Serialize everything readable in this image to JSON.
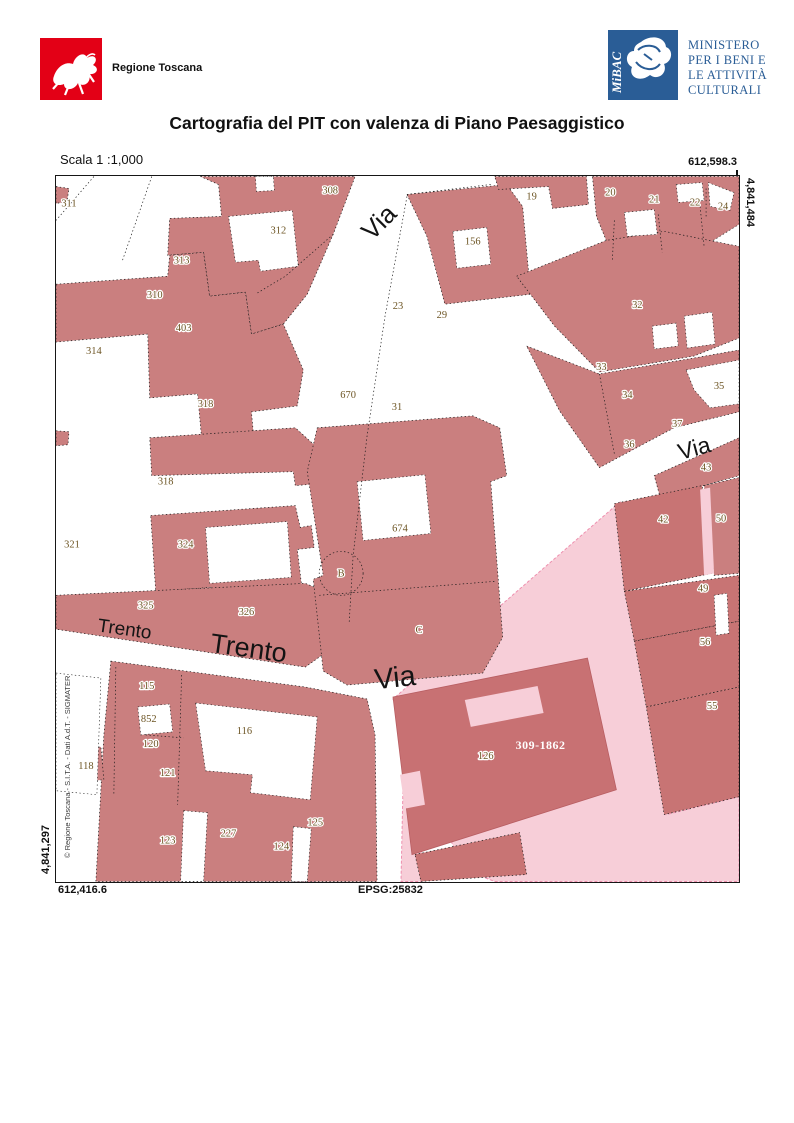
{
  "header": {
    "regione_label": "Regione Toscana",
    "mibac_logo_text": "MiBAC",
    "mibac_lines": [
      "MINISTERO",
      "PER I BENI E",
      "LE ATTIVITÀ",
      "CULTURALI"
    ]
  },
  "title": "Cartografia del PIT con valenza di Piano Paesaggistico",
  "scale_label": "Scala 1 :1,000",
  "coordinates": {
    "top_right": "612,598.3",
    "right_vertical": "4,841,484",
    "left_vertical": "4,841,297",
    "bottom_left": "612,416.6",
    "epsg": "EPSG:25832"
  },
  "attribution": "© Regione Toscana - S.I.T.A. - Dati A.d.T. - SIGMATER",
  "colors": {
    "building_rose": "#ca7f7f",
    "building_dark_rose": "#c87474",
    "zone_light_pink": "#f7ced8",
    "zone_border_pink": "#ee8fae",
    "parcel_text": "#6d5524",
    "regione_red": "#e30016",
    "mibac_blue": "#2a5d96"
  },
  "map": {
    "parcel_labels": [
      {
        "t": "311",
        "x": 13,
        "y": 30
      },
      {
        "t": "308",
        "x": 275,
        "y": 17
      },
      {
        "t": "312",
        "x": 223,
        "y": 57
      },
      {
        "t": "313",
        "x": 126,
        "y": 87
      },
      {
        "t": "310",
        "x": 99,
        "y": 122
      },
      {
        "t": "403",
        "x": 128,
        "y": 155
      },
      {
        "t": "314",
        "x": 38,
        "y": 178
      },
      {
        "t": "318",
        "x": 150,
        "y": 231
      },
      {
        "t": "318",
        "x": 110,
        "y": 309
      },
      {
        "t": "321",
        "x": 16,
        "y": 372
      },
      {
        "t": "324",
        "x": 130,
        "y": 372
      },
      {
        "t": "325",
        "x": 90,
        "y": 433
      },
      {
        "t": "326",
        "x": 191,
        "y": 440
      },
      {
        "t": "674",
        "x": 345,
        "y": 356
      },
      {
        "t": "670",
        "x": 293,
        "y": 222
      },
      {
        "t": "31",
        "x": 342,
        "y": 234
      },
      {
        "t": "23",
        "x": 343,
        "y": 133
      },
      {
        "t": "29",
        "x": 387,
        "y": 142
      },
      {
        "t": "156",
        "x": 418,
        "y": 68
      },
      {
        "t": "19",
        "x": 477,
        "y": 23
      },
      {
        "t": "20",
        "x": 556,
        "y": 19
      },
      {
        "t": "21",
        "x": 600,
        "y": 26
      },
      {
        "t": "22",
        "x": 641,
        "y": 29
      },
      {
        "t": "24",
        "x": 669,
        "y": 33
      },
      {
        "t": "32",
        "x": 583,
        "y": 132
      },
      {
        "t": "33",
        "x": 547,
        "y": 194
      },
      {
        "t": "34",
        "x": 573,
        "y": 222
      },
      {
        "t": "35",
        "x": 665,
        "y": 213
      },
      {
        "t": "37",
        "x": 623,
        "y": 251
      },
      {
        "t": "36",
        "x": 575,
        "y": 272
      },
      {
        "t": "43",
        "x": 652,
        "y": 295
      },
      {
        "t": "42",
        "x": 609,
        "y": 347
      },
      {
        "t": "50",
        "x": 667,
        "y": 346
      },
      {
        "t": "49",
        "x": 649,
        "y": 416
      },
      {
        "t": "56",
        "x": 651,
        "y": 470
      },
      {
        "t": "55",
        "x": 658,
        "y": 534
      },
      {
        "t": "115",
        "x": 91,
        "y": 514
      },
      {
        "t": "852",
        "x": 93,
        "y": 547
      },
      {
        "t": "120",
        "x": 95,
        "y": 572
      },
      {
        "t": "118",
        "x": 30,
        "y": 594
      },
      {
        "t": "121",
        "x": 112,
        "y": 601
      },
      {
        "t": "116",
        "x": 189,
        "y": 559
      },
      {
        "t": "123",
        "x": 112,
        "y": 669
      },
      {
        "t": "227",
        "x": 173,
        "y": 662
      },
      {
        "t": "124",
        "x": 226,
        "y": 675
      },
      {
        "t": "125",
        "x": 260,
        "y": 651
      },
      {
        "t": "126",
        "x": 431,
        "y": 584
      }
    ],
    "street_labels": [
      {
        "t": "Via",
        "x": 330,
        "y": 52,
        "r": -45,
        "s": 26
      },
      {
        "t": "Via",
        "x": 642,
        "y": 280,
        "r": -15,
        "s": 23
      },
      {
        "t": "Via",
        "x": 341,
        "y": 512,
        "r": -6,
        "s": 29
      },
      {
        "t": "Trento",
        "x": 68,
        "y": 460,
        "r": 8,
        "s": 19
      },
      {
        "t": "Trento",
        "x": 192,
        "y": 482,
        "r": 8,
        "s": 27
      }
    ],
    "markers": [
      {
        "t": "B",
        "x": 286,
        "y": 401
      },
      {
        "t": "C",
        "x": 364,
        "y": 458
      }
    ],
    "zone_label": {
      "t": "309-1862",
      "x": 486,
      "y": 574
    }
  }
}
